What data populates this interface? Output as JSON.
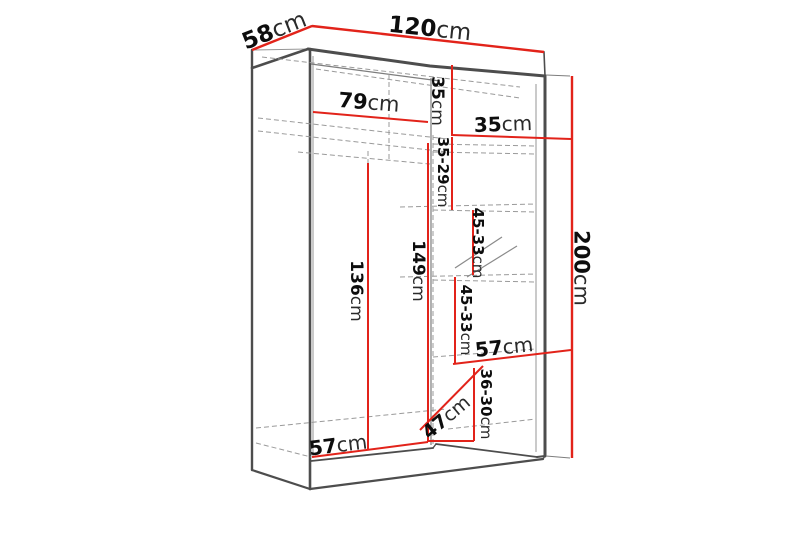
{
  "diagram": {
    "type": "wardrobe-dimension-drawing",
    "unit": "cm",
    "colors": {
      "dimension_line": "#e2231a",
      "outline": "#4d4d4d",
      "hidden_line": "#9a9a9a",
      "label_text": "#0d0d0d",
      "background": "#ffffff"
    },
    "dimensions": {
      "overall_width": {
        "value": "120",
        "unit": "cm"
      },
      "overall_depth": {
        "value": "58",
        "unit": "cm"
      },
      "overall_height": {
        "value": "200",
        "unit": "cm"
      },
      "left_section_width": {
        "value": "79",
        "unit": "cm"
      },
      "top_section_height": {
        "value": "35",
        "unit": "cm"
      },
      "right_section_width": {
        "value": "35",
        "unit": "cm"
      },
      "shelf_gap_1": {
        "value": "35-29",
        "unit": "cm"
      },
      "shelf_gap_2": {
        "value": "45-33",
        "unit": "cm"
      },
      "shelf_gap_3": {
        "value": "45-33",
        "unit": "cm"
      },
      "lower_shelf_width": {
        "value": "57",
        "unit": "cm"
      },
      "shelf_gap_4": {
        "value": "36-30",
        "unit": "cm"
      },
      "lower_right_depth": {
        "value": "47",
        "unit": "cm"
      },
      "hanging_height": {
        "value": "136",
        "unit": "cm"
      },
      "interior_height": {
        "value": "149",
        "unit": "cm"
      },
      "interior_depth": {
        "value": "57",
        "unit": "cm"
      }
    }
  }
}
